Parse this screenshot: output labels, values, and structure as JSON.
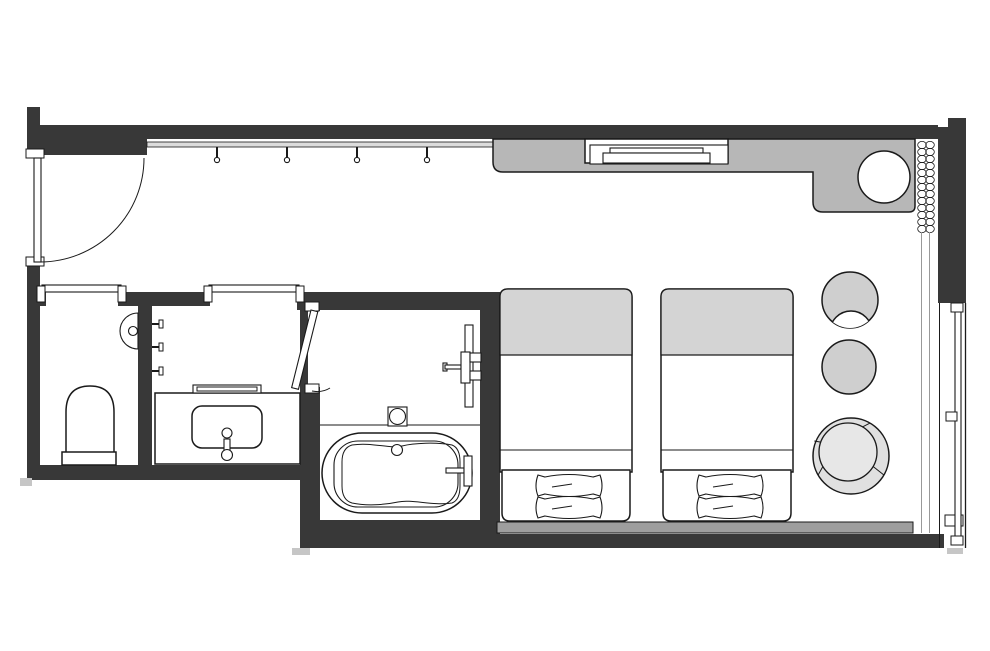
{
  "plan": {
    "kind": "hotel-guestroom-floor-plan",
    "colors": {
      "background": "#ffffff",
      "wall": "#383838",
      "outline": "#1a1a1a",
      "counter": "#b7b7b7",
      "bedAccent": "#d4d4d4",
      "headboard": "#9e9e9e",
      "furniture": "#cfcfcf",
      "loungeRing": "#e0e0e0",
      "loungeSeat": "#e7e7e7",
      "rail": "#dcdcdc",
      "step": "#c6c6c6",
      "track": "#999999"
    },
    "symbols": [
      {
        "name": "entry-door",
        "kind": "hinged-door-with-swing-arc"
      },
      {
        "name": "coat-rail-with-hooks",
        "kind": "rail, 4 hooks"
      },
      {
        "name": "tv-counter",
        "kind": "recessed console with television"
      },
      {
        "name": "counter-sink-unit",
        "kind": "L-counter with round basin"
      },
      {
        "name": "curtain",
        "kind": "coiled curtain symbol with double track"
      },
      {
        "name": "window",
        "kind": "full-height glazing with sash and latch"
      },
      {
        "name": "twin-bed",
        "kind": "bed with folded cover and two pillows, x2"
      },
      {
        "name": "headboard-panel",
        "kind": "shared headboard strip"
      },
      {
        "name": "crescent-chair",
        "kind": "round chair, concave front"
      },
      {
        "name": "side-table",
        "kind": "round table"
      },
      {
        "name": "lounge-chair",
        "kind": "segmented round tub chair"
      },
      {
        "name": "toilet",
        "kind": "WC with cistern base"
      },
      {
        "name": "toilet-paper-holder",
        "kind": "wall semicircle"
      },
      {
        "name": "sliding-door",
        "kind": "pocket slider, x2"
      },
      {
        "name": "washbasin-counter",
        "kind": "vanity with basin, faucet, shelf"
      },
      {
        "name": "towel-hooks",
        "kind": "3 wall cleats"
      },
      {
        "name": "bathroom-door",
        "kind": "leaf shown ajar"
      },
      {
        "name": "shower-mixer",
        "kind": "wall mixer with arm and column"
      },
      {
        "name": "floor-drain",
        "kind": "square drain with circle"
      },
      {
        "name": "bathtub",
        "kind": "oval tub with inner rim, drain, filler"
      }
    ]
  }
}
